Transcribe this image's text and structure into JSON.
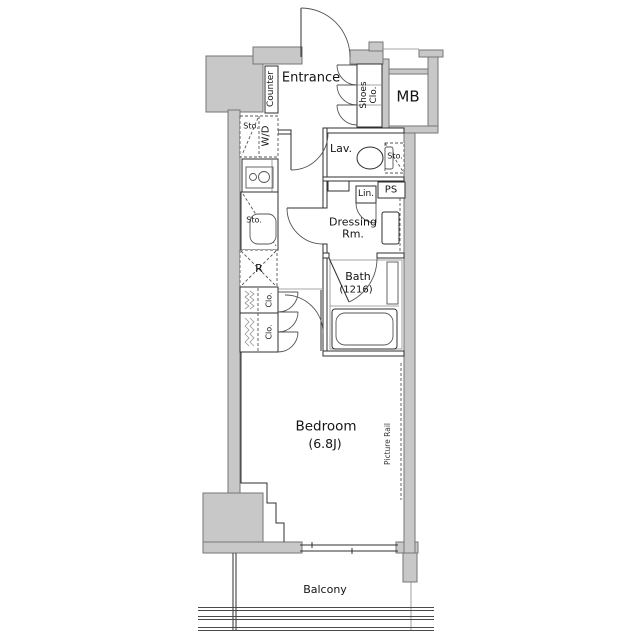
{
  "plan": {
    "entrance": "Entrance",
    "counter": "Counter",
    "shoes_closet": "Shoes Clo.",
    "meter_box": "MB",
    "storage_entry": "Sto.",
    "washer_dryer": "W/D",
    "lavatory": "Lav.",
    "storage_lavatory": "Sto.",
    "pipe_space": "PS",
    "linen": "Lin.",
    "dressing_room": "Dressing Rm.",
    "storage_kitchen": "Sto.",
    "refrigerator": "R",
    "bath_name": "Bath",
    "bath_size": "(1216)",
    "closet_upper": "Clo.",
    "closet_lower": "Clo.",
    "bedroom_name": "Bedroom",
    "bedroom_size": "(6.8J)",
    "picture_rail": "Picture Rail",
    "balcony": "Balcony"
  },
  "colors": {
    "background": "#ffffff",
    "wall_fill": "#c8c8c8",
    "wall_stroke": "#767676",
    "line": "#2f2f2f"
  }
}
